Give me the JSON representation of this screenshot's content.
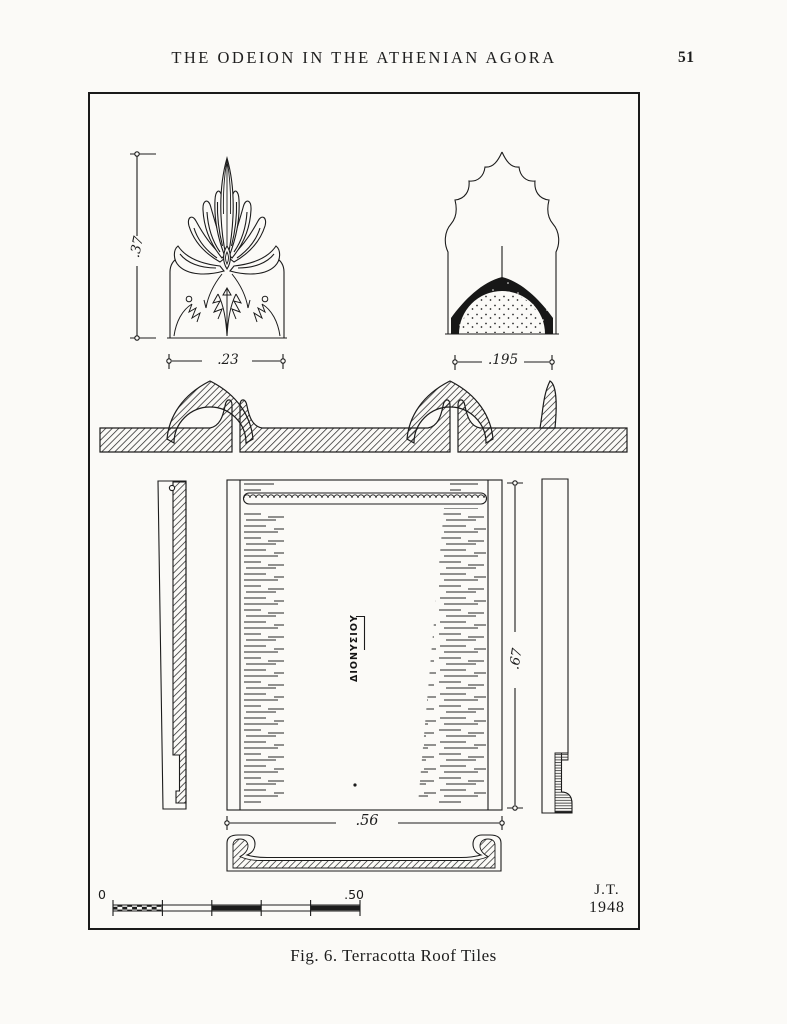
{
  "page": {
    "header": "THE ODEION IN THE ATHENIAN AGORA",
    "page_number": "51",
    "caption": "Fig. 6. Terracotta Roof Tiles"
  },
  "figure": {
    "dimensions": {
      "antefix_height": ".37",
      "antefix_width": ".23",
      "cover_tile_width": ".195",
      "pan_tile_length": ".67",
      "pan_tile_width": ".56"
    },
    "stamp_text": "ΔΙΟΝΥΣΙΟΥ",
    "scale": {
      "zero": "0",
      "half_meter": ".50"
    },
    "signature_initials": "J.T.",
    "signature_year": "1948"
  },
  "colors": {
    "ink": "#1c1c1c",
    "paper": "#fbfaf7"
  }
}
